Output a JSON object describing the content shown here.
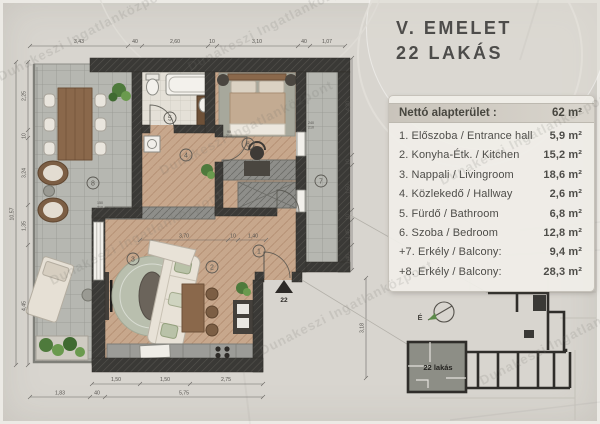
{
  "watermark": "Dunakeszi Ingatlanközpont",
  "panel": {
    "title_line1": "V. EMELET",
    "title_line2": "22 LAKÁS",
    "table": {
      "header": {
        "label": "Nettó alapterület :",
        "value": "62 m²"
      },
      "rows": [
        {
          "label": "1. Előszoba / Entrance hall",
          "value": "5,9 m²"
        },
        {
          "label": "2. Konyha-Étk. / Kitchen",
          "value": "15,2 m²"
        },
        {
          "label": "3. Nappali / Livingroom",
          "value": "18,6 m²"
        },
        {
          "label": "4. Közlekedő / Hallway",
          "value": "2,6 m²"
        },
        {
          "label": "5. Fürdő / Bathroom",
          "value": "6,8 m²"
        },
        {
          "label": "6. Szoba / Bedroom",
          "value": "12,8 m²"
        },
        {
          "label": "+7. Erkély / Balcony:",
          "value": "9,4 m²"
        },
        {
          "label": "+8. Erkély / Balcony:",
          "value": "28,3 m²"
        }
      ]
    }
  },
  "plan": {
    "rooms": [
      "1",
      "2",
      "3",
      "4",
      "5",
      "6",
      "7",
      "8"
    ],
    "entrance_marker": "22",
    "dims_top": [
      "3,43",
      "40",
      "2,60",
      "10",
      "3,10",
      "40",
      "1,07"
    ],
    "dims_bottom_inner": [
      "1,50",
      "1,50",
      "2,75"
    ],
    "dims_bottom_outer": [
      "1,83",
      "40",
      "5,75"
    ],
    "dims_left": [
      "2,25",
      "10",
      "3,24",
      "1,35",
      "4,45"
    ],
    "dims_left_total": "10,57",
    "dims_right": [
      "4,20",
      "10",
      "1,50",
      "10",
      "1,45",
      "1,40"
    ],
    "dim_right_low": "3,18",
    "dims_living": [
      "3,70",
      "10",
      "1,40"
    ],
    "door_tags": [
      {
        "w": "90",
        "h": "210"
      },
      {
        "w": "240",
        "h": "210"
      },
      {
        "w": "150",
        "h": "210"
      }
    ],
    "colors": {
      "wall": "#3a3936",
      "wood_floor": "#c7a78c",
      "tile": "#b6b7b1",
      "accent_green": "#557f3e"
    }
  },
  "minimap": {
    "north_label": "É",
    "unit_label": "22 lakás"
  }
}
